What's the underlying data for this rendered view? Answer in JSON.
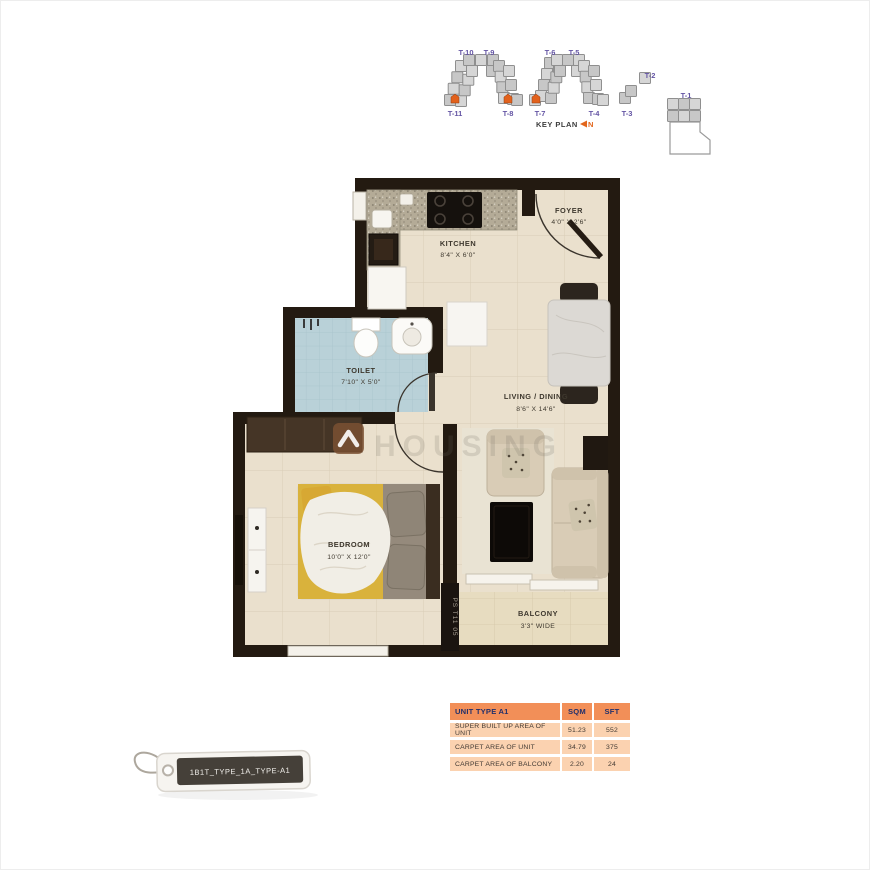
{
  "key_plan": {
    "title": "KEY PLAN",
    "north_label": "N",
    "towers": [
      {
        "label": "T-10"
      },
      {
        "label": "T-9"
      },
      {
        "label": "T-6"
      },
      {
        "label": "T-5"
      },
      {
        "label": "T-2"
      },
      {
        "label": "T-11"
      },
      {
        "label": "T-8"
      },
      {
        "label": "T-7"
      },
      {
        "label": "T-4"
      },
      {
        "label": "T-3"
      },
      {
        "label": "T-1"
      }
    ],
    "highlighted_towers": "T-11, T-8, T-7",
    "colors": {
      "block_fill": "#d6d6d6",
      "block_stroke": "#8f8f8f",
      "highlight": "#e2611c",
      "label": "#6455a4"
    }
  },
  "plan": {
    "rooms": {
      "kitchen": {
        "name": "KITCHEN",
        "dims": "8'4\" X 6'0\""
      },
      "foyer": {
        "name": "FOYER",
        "dims": "4'0\" X 2'6\""
      },
      "toilet": {
        "name": "TOILET",
        "dims": "7'10\" X 5'0\""
      },
      "living": {
        "name": "LIVING / DINING",
        "dims": "8'6\" X 14'6\""
      },
      "bedroom": {
        "name": "BEDROOM",
        "dims": "10'0\" X 12'0\""
      },
      "balcony": {
        "name": "BALCONY",
        "dims": "3'3\" WIDE"
      }
    },
    "stack_label": "PS T11 05",
    "watermark_text": "HOUSING",
    "colors": {
      "wall": "#231a11",
      "floor": "#eae0cd",
      "toilet_floor": "#b9d1d8",
      "bed_throw": "#d9b23c"
    }
  },
  "area_table": {
    "header": {
      "title": "UNIT TYPE A1",
      "sqm": "SQM",
      "sft": "SFT"
    },
    "rows": [
      {
        "label": "SUPER BUILT UP AREA OF UNIT",
        "sqm": "51.23",
        "sft": "552"
      },
      {
        "label": "CARPET AREA OF UNIT",
        "sqm": "34.79",
        "sft": "375"
      },
      {
        "label": "CARPET AREA OF BALCONY",
        "sqm": "2.20",
        "sft": "24"
      }
    ],
    "colors": {
      "header_bg": "#f28f58",
      "row_bg": "#fbd2b0",
      "header_text": "#22306b",
      "row_text": "#423a33"
    }
  },
  "tag": {
    "label": "1B1T_TYPE_1A_TYPE-A1"
  }
}
